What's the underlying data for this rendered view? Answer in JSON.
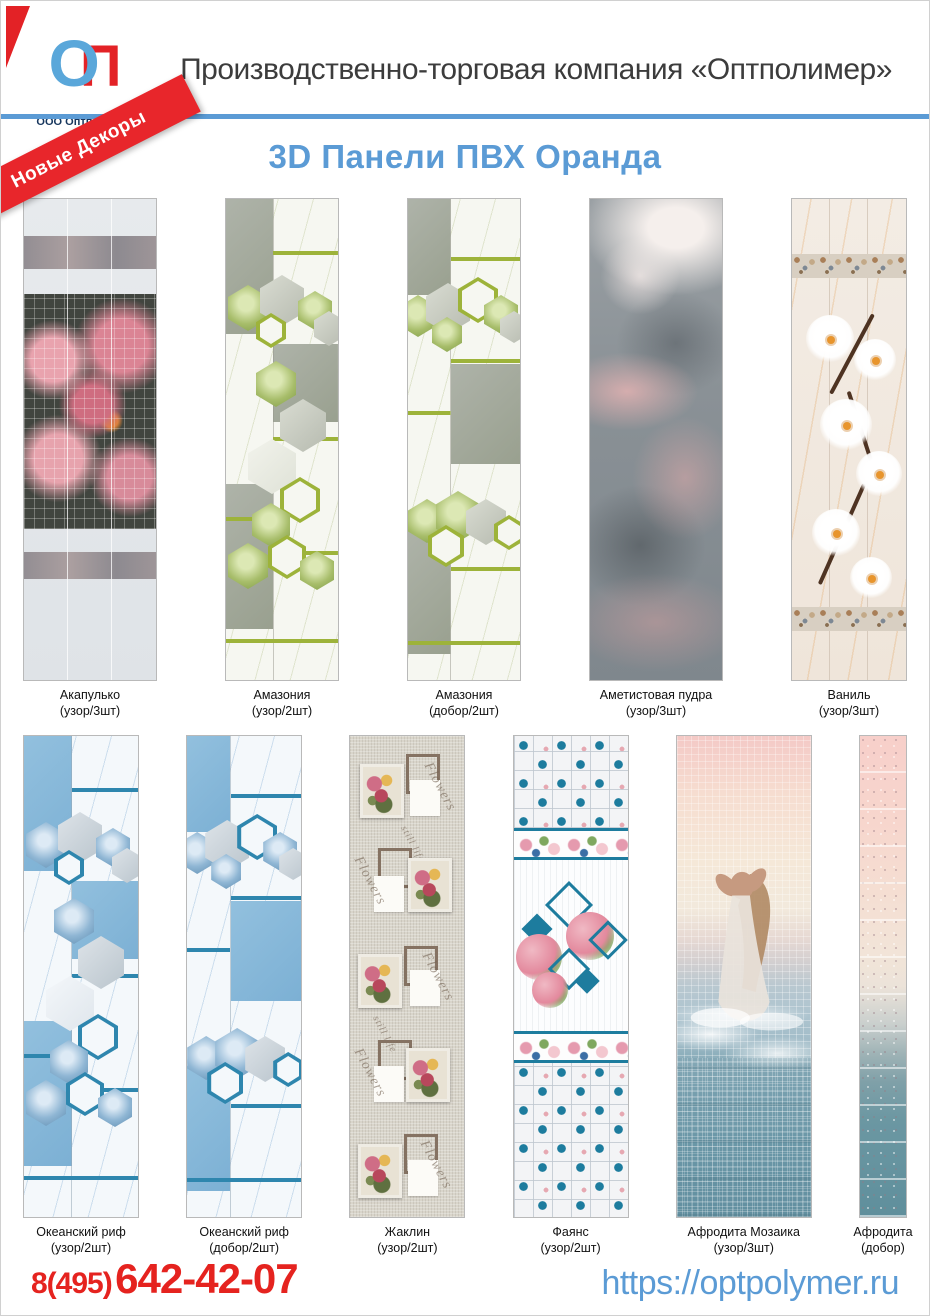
{
  "header": {
    "logo_o": "О",
    "logo_p": "П",
    "company_label": "ООО Оптполимер",
    "title": "Производственно-торговая компания «Оптполимер»"
  },
  "ribbon_label": "Новые Декоры",
  "page_title": "3D Панели ПВХ Оранда",
  "panels_row1": [
    {
      "name": "Акапулько",
      "spec": "(узор/3шт)"
    },
    {
      "name": "Амазония",
      "spec": "(узор/2шт)"
    },
    {
      "name": "Амазония",
      "spec": "(добор/2шт)"
    },
    {
      "name": "Аметистовая пудра",
      "spec": "(узор/3шт)"
    },
    {
      "name": "Ваниль",
      "spec": "(узор/3шт)"
    }
  ],
  "panels_row2": [
    {
      "name": "Океанский риф",
      "spec": "(узор/2шт)"
    },
    {
      "name": "Океанский риф",
      "spec": "(добор/2шт)"
    },
    {
      "name": "Жаклин",
      "spec": "(узор/2шт)"
    },
    {
      "name": "Фаянс",
      "spec": "(узор/2шт)"
    },
    {
      "name": "Афродита Мозаика",
      "spec": "(узор/3шт)"
    },
    {
      "name": "Афродита",
      "spec": "(добор)"
    }
  ],
  "jacqueline_texts": {
    "flowers": "Flowers",
    "still_life": "still life"
  },
  "footer": {
    "phone_prefix": "8(495)",
    "phone_number": "642-42-07",
    "website": "https://optpolymer.ru"
  },
  "colors": {
    "accent_blue": "#5b9bd5",
    "brand_red": "#e5231f",
    "ribbon_red": "#e8262b",
    "logo_blue": "#5aa7da",
    "logo_red": "#e32226",
    "navy": "#17365d",
    "green_accent": "#9db33a",
    "teal_accent": "#1d7c9e"
  }
}
